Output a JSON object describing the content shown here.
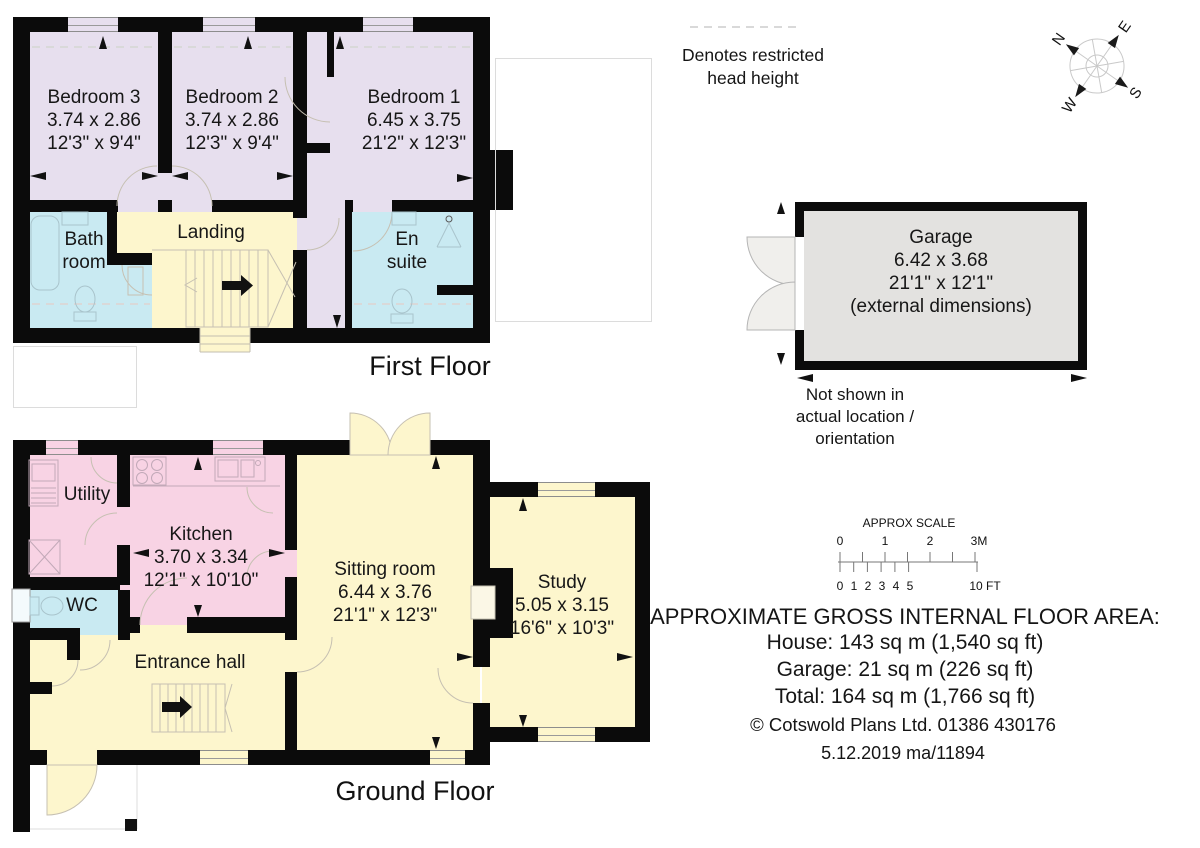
{
  "legend": {
    "lines": [
      "Denotes restricted",
      "head height"
    ]
  },
  "compass": {
    "n": "N",
    "e": "E",
    "s": "S",
    "w": "W"
  },
  "first_floor": {
    "title": "First Floor",
    "bedroom3": {
      "name": "Bedroom 3",
      "metric": "3.74 x 2.86",
      "imperial": "12'3\" x 9'4\""
    },
    "bedroom2": {
      "name": "Bedroom 2",
      "metric": "3.74 x 2.86",
      "imperial": "12'3\" x 9'4\""
    },
    "bedroom1": {
      "name": "Bedroom 1",
      "metric": "6.45 x 3.75",
      "imperial": "21'2\" x 12'3\""
    },
    "bathroom": {
      "line1": "Bath",
      "line2": "room"
    },
    "landing": {
      "name": "Landing"
    },
    "ensuite": {
      "line1": "En",
      "line2": "suite"
    }
  },
  "ground_floor": {
    "title": "Ground Floor",
    "utility": {
      "name": "Utility"
    },
    "kitchen": {
      "name": "Kitchen",
      "metric": "3.70 x 3.34",
      "imperial": "12'1\" x 10'10\""
    },
    "wc": {
      "name": "WC"
    },
    "sitting_room": {
      "name": "Sitting room",
      "metric": "6.44 x 3.76",
      "imperial": "21'1\" x 12'3\""
    },
    "study": {
      "name": "Study",
      "metric": "5.05 x 3.15",
      "imperial": "16'6\" x 10'3\""
    },
    "entrance_hall": {
      "name": "Entrance hall"
    }
  },
  "garage": {
    "name": "Garage",
    "metric": "6.42 x 3.68",
    "imperial": "21'1\" x 12'1\"",
    "note": "(external dimensions)",
    "caption_lines": [
      "Not shown in",
      "actual location /",
      "orientation"
    ]
  },
  "scale_bar": {
    "title": "APPROX SCALE",
    "meters": [
      "0",
      "1",
      "2",
      "3M"
    ],
    "feet": [
      "0",
      "1",
      "2",
      "3",
      "4",
      "5",
      "10 FT"
    ]
  },
  "areas": {
    "title": "APPROXIMATE GROSS INTERNAL FLOOR AREA:",
    "house": "House: 143 sq m (1,540 sq ft)",
    "garage": "Garage: 21 sq m (226 sq ft)",
    "total": "Total: 164 sq m (1,766 sq ft)",
    "copyright": "©  Cotswold Plans Ltd. 01386 430176",
    "date_ref": "5.12.2019 ma/11894"
  },
  "colors": {
    "bedroom": "#e7dfee",
    "bathroom": "#c9eaf2",
    "hall": "#fdf6cd",
    "kitchen": "#f8d3e4",
    "garage": "#e3e2e0",
    "wall": "#0b0b0b"
  }
}
